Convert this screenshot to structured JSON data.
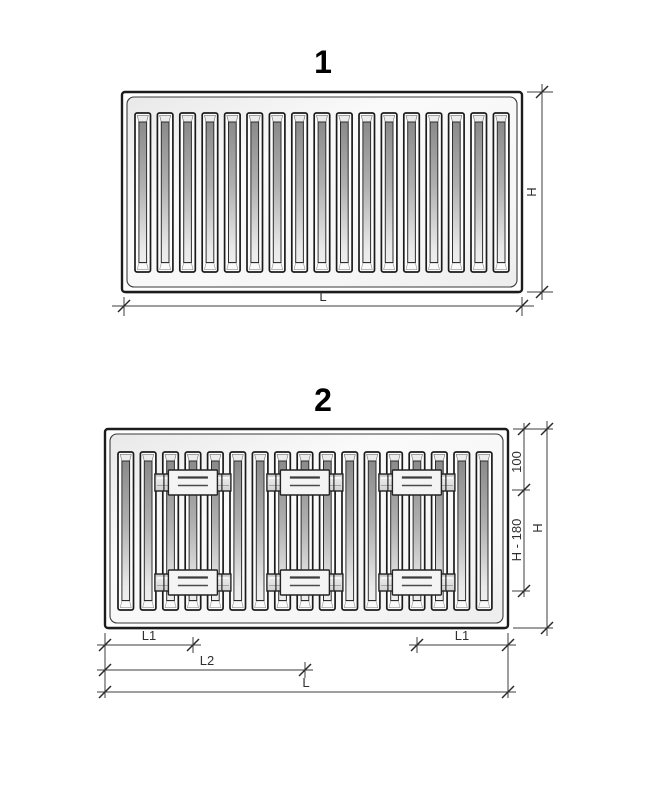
{
  "figures": [
    {
      "number": "1",
      "fin_count": 17,
      "dims": {
        "height": "H",
        "length": "L"
      }
    },
    {
      "number": "2",
      "fin_count": 17,
      "brackets": {
        "columns": 3,
        "rows": 2,
        "at_fin_indices": [
          3,
          8,
          13
        ]
      },
      "dims": {
        "top_offset": "100",
        "middle_span": "H - 180",
        "height": "H",
        "bracket_offset_left": "L1",
        "bracket_offset_right": "L1",
        "center_span": "L2",
        "length": "L"
      }
    }
  ],
  "colors": {
    "background": "#ffffff",
    "ink": "#2f2f2f",
    "panel_border": "#1c1c1c"
  }
}
